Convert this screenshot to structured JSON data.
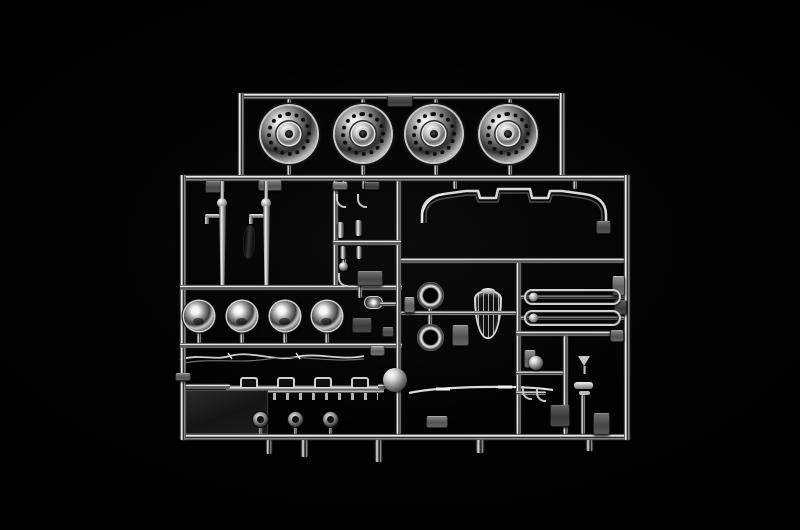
{
  "image": {
    "type": "photograph",
    "subject": "Chrome-plated plastic model-kit sprue (parts tree) on a black background",
    "background_color": "#000000",
    "palette": {
      "chrome_highlight": "#f2f2f2",
      "chrome_mid": "#8a8a8a",
      "chrome_shadow": "#1a1a1a",
      "tab_gray": "#6e6e6e"
    },
    "inventory": [
      "4 wheel rims (top row)",
      "2 exhaust stacks",
      "front bumper",
      "4 headlight buckets",
      "shield-shaped grille badge",
      "2 chrome rings",
      "2 oval mirror frames",
      "light bar with brackets",
      "3 small lamp lenses",
      "large chrome sphere",
      "dark flat plate",
      "wiper arms",
      "trim strip",
      "funnel and air-horn parts"
    ]
  },
  "sprue": {
    "runners": [
      [
        238,
        93,
        327,
        6
      ],
      [
        238,
        93,
        6,
        86
      ],
      [
        559,
        93,
        6,
        86
      ],
      [
        180,
        175,
        450,
        6
      ],
      [
        180,
        434,
        450,
        6
      ],
      [
        180,
        175,
        6,
        265
      ],
      [
        624,
        175,
        6,
        265
      ],
      [
        333,
        181,
        5,
        106
      ],
      [
        180,
        285,
        222,
        5
      ],
      [
        180,
        343,
        222,
        5
      ],
      [
        396,
        181,
        5,
        253
      ],
      [
        401,
        258,
        223,
        5
      ],
      [
        516,
        263,
        5,
        171
      ],
      [
        516,
        331,
        108,
        5
      ],
      [
        563,
        336,
        5,
        98
      ],
      [
        521,
        295,
        103,
        4
      ],
      [
        521,
        316,
        103,
        4
      ],
      [
        401,
        311,
        115,
        4
      ],
      [
        333,
        240,
        68,
        5
      ],
      [
        516,
        371,
        47,
        4
      ],
      [
        516,
        391,
        30,
        4
      ],
      [
        581,
        395,
        4,
        39
      ],
      [
        287,
        99,
        4,
        8
      ],
      [
        361,
        99,
        4,
        8
      ],
      [
        434,
        99,
        4,
        8
      ],
      [
        508,
        99,
        4,
        8
      ],
      [
        287,
        158,
        4,
        17
      ],
      [
        361,
        158,
        4,
        17
      ],
      [
        434,
        158,
        4,
        17
      ],
      [
        508,
        158,
        4,
        17
      ],
      [
        197,
        328,
        4,
        15
      ],
      [
        240,
        328,
        4,
        15
      ],
      [
        283,
        328,
        4,
        15
      ],
      [
        325,
        328,
        4,
        15
      ],
      [
        259,
        424,
        3,
        10
      ],
      [
        294,
        424,
        3,
        10
      ],
      [
        329,
        424,
        3,
        10
      ],
      [
        342,
        181,
        4,
        8
      ],
      [
        362,
        181,
        4,
        8
      ],
      [
        453,
        181,
        4,
        8
      ],
      [
        573,
        181,
        4,
        8
      ],
      [
        428,
        301,
        4,
        10
      ],
      [
        428,
        315,
        4,
        11
      ],
      [
        186,
        384,
        44,
        5
      ],
      [
        378,
        384,
        20,
        5
      ],
      [
        358,
        285,
        4,
        13
      ],
      [
        380,
        302,
        16,
        4
      ],
      [
        342,
        252,
        4,
        12
      ]
    ],
    "gates": [
      [
        266,
        440,
        6,
        14
      ],
      [
        301,
        440,
        7,
        17
      ],
      [
        375,
        440,
        7,
        22
      ],
      [
        476,
        440,
        8,
        13
      ],
      [
        586,
        440,
        7,
        11
      ]
    ],
    "tabs": [
      [
        387,
        96,
        26,
        11
      ],
      [
        205,
        181,
        20,
        12
      ],
      [
        258,
        180,
        24,
        11
      ],
      [
        332,
        182,
        16,
        8
      ],
      [
        364,
        182,
        16,
        8
      ],
      [
        357,
        271,
        26,
        15
      ],
      [
        452,
        325,
        17,
        21
      ],
      [
        404,
        297,
        11,
        16
      ],
      [
        352,
        318,
        20,
        15
      ],
      [
        382,
        327,
        12,
        10
      ],
      [
        426,
        416,
        22,
        12
      ],
      [
        524,
        350,
        12,
        18
      ],
      [
        550,
        405,
        20,
        22
      ],
      [
        593,
        413,
        17,
        22
      ],
      [
        610,
        330,
        14,
        12
      ],
      [
        612,
        276,
        13,
        20
      ],
      [
        614,
        300,
        13,
        15
      ],
      [
        596,
        221,
        15,
        13
      ],
      [
        175,
        373,
        16,
        8
      ],
      [
        370,
        346,
        15,
        10
      ]
    ],
    "wheels": {
      "d": 56,
      "items": [
        [
          261,
          106
        ],
        [
          335,
          106
        ],
        [
          406,
          106
        ],
        [
          480,
          106
        ]
      ]
    },
    "headlights": {
      "d": 30,
      "items": [
        [
          184,
          301
        ],
        [
          227,
          301
        ],
        [
          270,
          301
        ],
        [
          312,
          301
        ]
      ]
    },
    "small_lights": {
      "d": 15,
      "items": [
        [
          253,
          412
        ],
        [
          288,
          412
        ],
        [
          323,
          412
        ]
      ]
    },
    "rings": {
      "d": 27,
      "items": [
        [
          417,
          282
        ],
        [
          417,
          324
        ]
      ]
    },
    "loops": {
      "w": 97,
      "h": 16,
      "items": [
        [
          524,
          289
        ],
        [
          524,
          310
        ]
      ]
    },
    "spheres": [
      [
        383,
        368,
        24
      ],
      [
        529,
        356,
        14
      ],
      [
        339,
        262,
        9
      ]
    ],
    "cylinders": [
      [
        337,
        222,
        7,
        16
      ],
      [
        355,
        220,
        7,
        16
      ],
      [
        340,
        246,
        6,
        13
      ],
      [
        356,
        246,
        6,
        13
      ]
    ],
    "hooks": [
      [
        336,
        194
      ],
      [
        357,
        194
      ],
      [
        338,
        273
      ],
      [
        522,
        386
      ],
      [
        536,
        388
      ]
    ],
    "exhausts": [
      [
        212,
        181
      ],
      [
        256,
        181
      ]
    ],
    "blade": [
      243,
      225,
      12,
      34
    ]
  }
}
